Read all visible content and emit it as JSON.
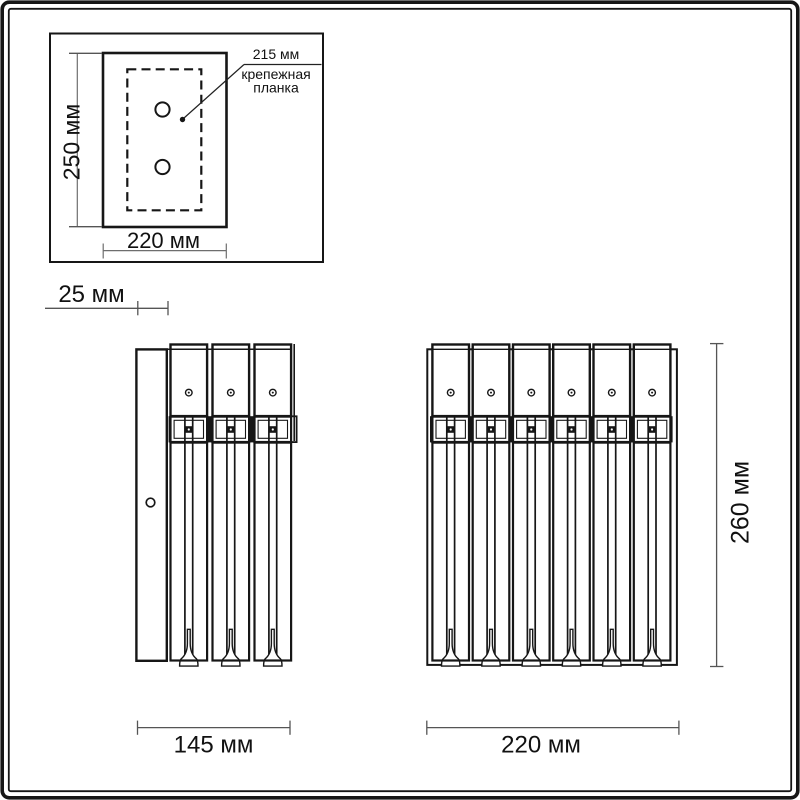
{
  "labels": {
    "plate_height": "250 мм",
    "plate_width": "220 мм",
    "mount_bar_width": "215 мм",
    "mount_bar_caption_1": "крепежная",
    "mount_bar_caption_2": "планка",
    "side_depth": "25 мм",
    "side_width": "145 мм",
    "front_width": "220 мм",
    "front_height": "260 мм"
  }
}
